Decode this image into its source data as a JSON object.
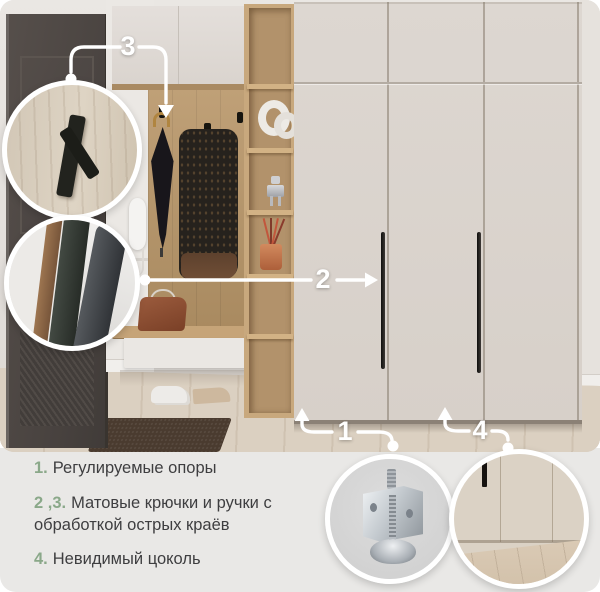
{
  "callouts": {
    "labels": [
      {
        "id": "callout-1",
        "number": "1"
      },
      {
        "id": "callout-2",
        "number": "2"
      },
      {
        "id": "callout-3",
        "number": "3"
      },
      {
        "id": "callout-4",
        "number": "4"
      }
    ]
  },
  "features": [
    {
      "number": "1.",
      "text": "Регулируемые опоры"
    },
    {
      "number": "2 ,3.",
      "text": "Матовые крючки и ручки с обработкой острых краёв"
    },
    {
      "number": "4.",
      "text": "Невидимый цоколь"
    }
  ],
  "colors": {
    "accent_green": "#8aa889",
    "callout_white": "#ffffff",
    "panel_bg": "#e9e8e6",
    "text": "#3e3e40"
  },
  "icons": {
    "dot": "connector-dot",
    "arrow": "connector-arrow"
  }
}
